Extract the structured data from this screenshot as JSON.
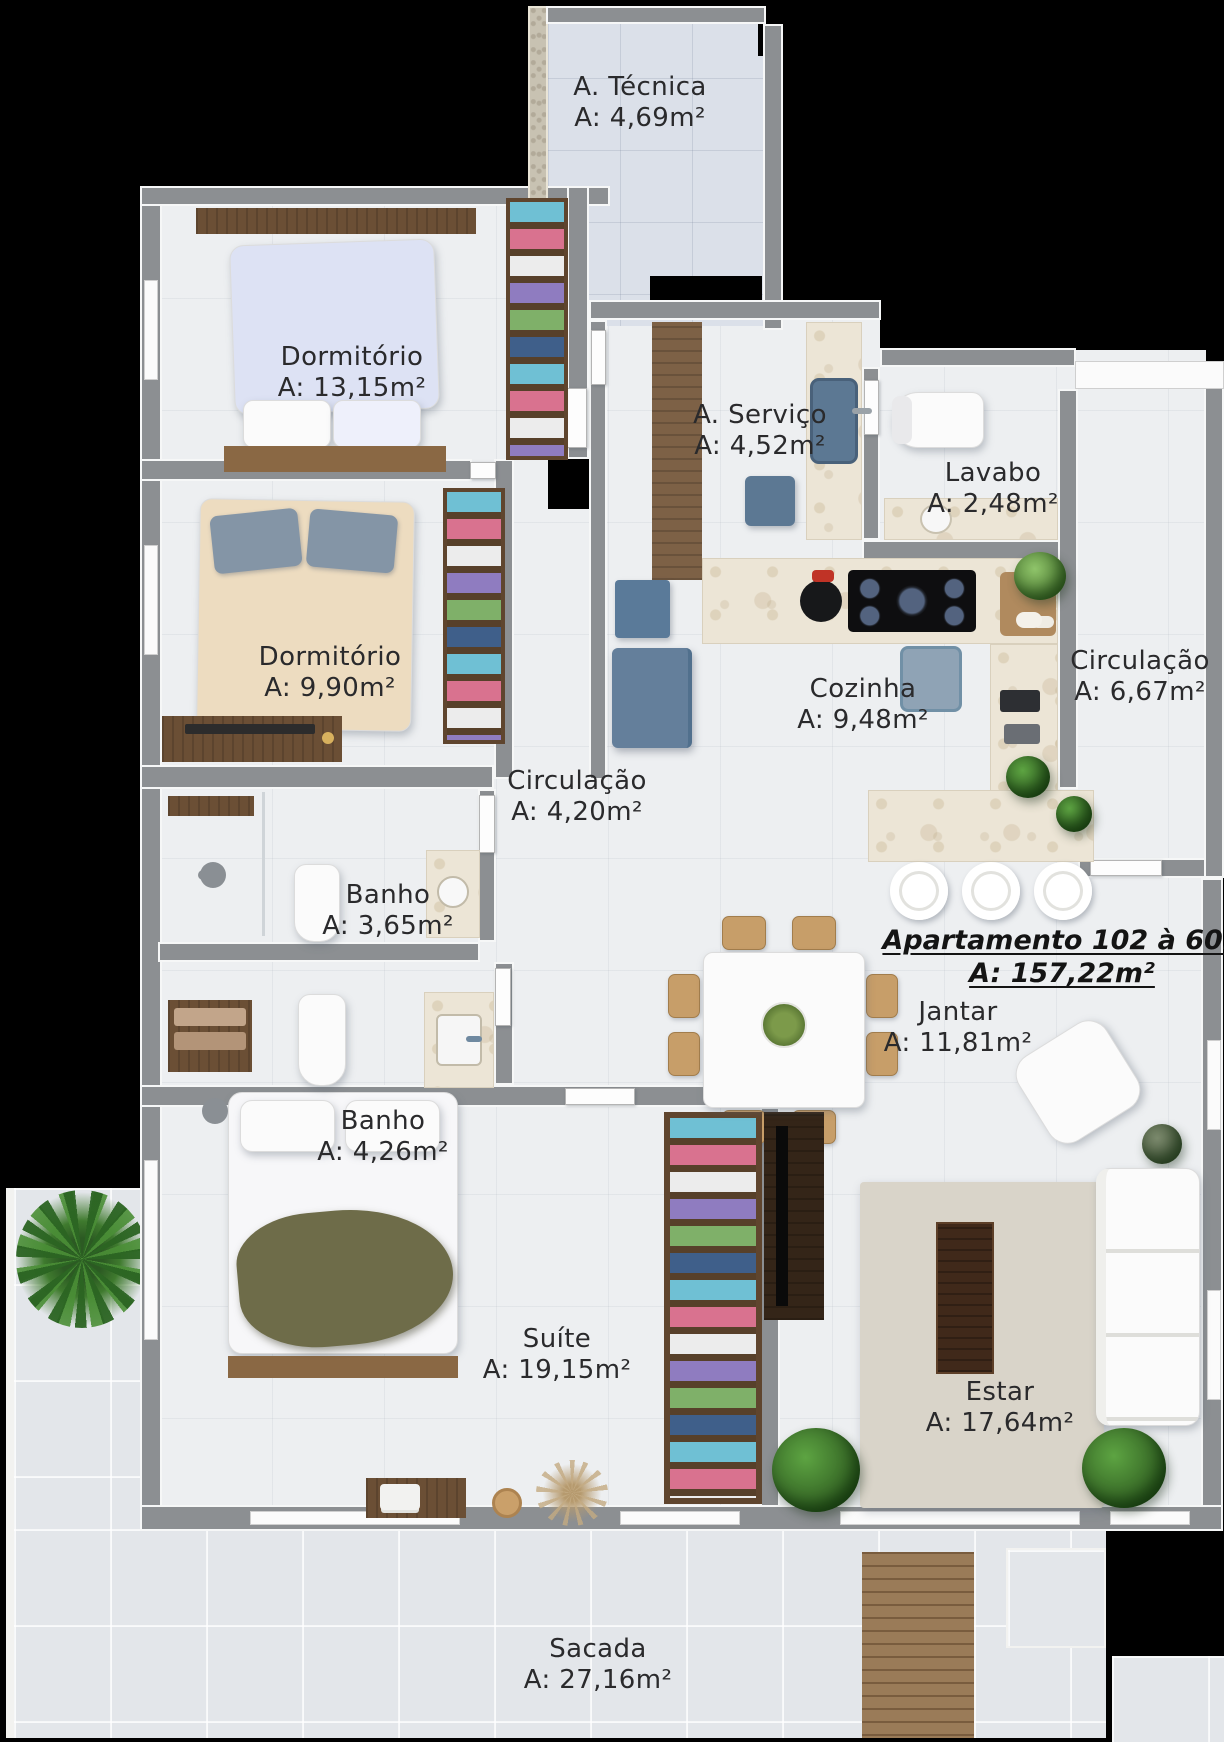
{
  "plan": {
    "title": {
      "name": "Apartamento 102 à 602",
      "area": "A: 157,22m²"
    },
    "rooms": [
      {
        "name": "A. Técnica",
        "area": "A: 4,69m²"
      },
      {
        "name": "Dormitório",
        "area": "A: 13,15m²"
      },
      {
        "name": "A. Serviço",
        "area": "A: 4,52m²"
      },
      {
        "name": "Lavabo",
        "area": "A: 2,48m²"
      },
      {
        "name": "Dormitório",
        "area": "A: 9,90m²"
      },
      {
        "name": "Cozinha",
        "area": "A: 9,48m²"
      },
      {
        "name": "Circulação",
        "area": "A: 6,67m²"
      },
      {
        "name": "Circulação",
        "area": "A: 4,20m²"
      },
      {
        "name": "Banho",
        "area": "A: 3,65m²"
      },
      {
        "name": "Banho",
        "area": "A: 4,26m²"
      },
      {
        "name": "Jantar",
        "area": "A: 11,81m²"
      },
      {
        "name": "Suíte",
        "area": "A: 19,15m²"
      },
      {
        "name": "Estar",
        "area": "A: 17,64m²"
      },
      {
        "name": "Sacada",
        "area": "A: 27,16m²"
      }
    ],
    "palette": {
      "background": "#000000",
      "wall": "#8c8f92",
      "floor": "#edeff1",
      "balcony_floor": "#e3e6ea",
      "wood": "#6b4f35",
      "marble": "#ece5d6",
      "text": "#2a2a2c"
    }
  }
}
